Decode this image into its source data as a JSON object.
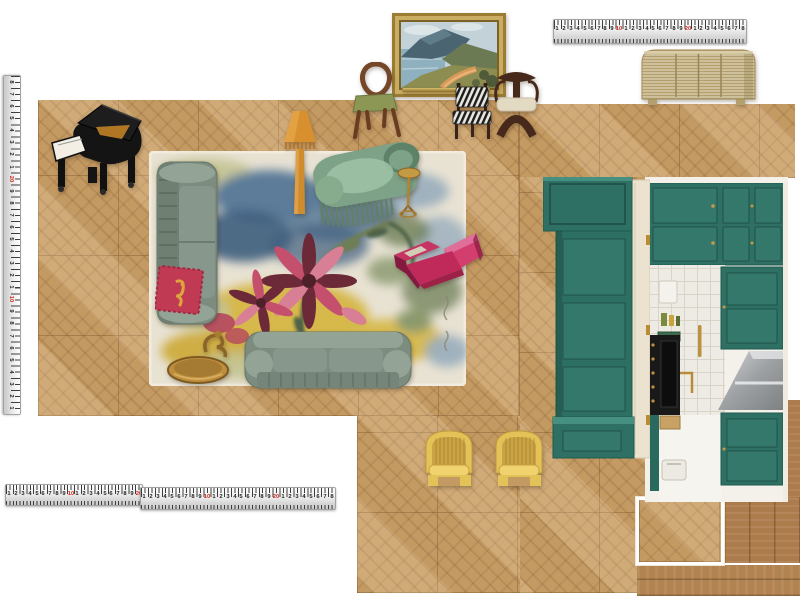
{
  "canvas": {
    "width": 800,
    "height": 600,
    "background": "#ffffff"
  },
  "rulers": {
    "red": [
      "10",
      "20"
    ],
    "top": {
      "numbers": [
        "1",
        "2",
        "3",
        "4",
        "5",
        "6",
        "7",
        "8",
        "9",
        "10",
        "1",
        "2",
        "3",
        "4",
        "5",
        "6",
        "7",
        "8",
        "9",
        "20",
        "1",
        "2",
        "3",
        "4",
        "5",
        "6",
        "7",
        "8"
      ]
    },
    "bottom_a": {
      "numbers": [
        "1",
        "2",
        "3",
        "4",
        "5",
        "6",
        "7",
        "8",
        "9",
        "10",
        "1",
        "2",
        "3",
        "4",
        "5",
        "6",
        "7",
        "8",
        "9",
        "20"
      ]
    },
    "bottom_b": {
      "numbers": [
        "1",
        "2",
        "3",
        "4",
        "5",
        "6",
        "7",
        "8",
        "9",
        "10",
        "1",
        "2",
        "3",
        "4",
        "5",
        "6",
        "7",
        "8",
        "9",
        "20",
        "1",
        "2",
        "3",
        "4",
        "5",
        "6",
        "7",
        "8"
      ]
    },
    "left": {
      "numbers": [
        "8",
        "7",
        "6",
        "5",
        "4",
        "3",
        "2",
        "1",
        "20",
        "9",
        "8",
        "7",
        "6",
        "5",
        "4",
        "3",
        "2",
        "1",
        "10",
        "9",
        "8",
        "7",
        "6",
        "5",
        "4",
        "3",
        "2",
        "1"
      ]
    }
  },
  "palette": {
    "white": "#ffffff",
    "offWhite": "#f4f1ea",
    "tick": "#3c3c3c",
    "redNum": "#cf2a20",
    "floorTan": "#c49a63",
    "teal": "#2e7164",
    "tealDark": "#1f5a4e",
    "tealLight": "#459081",
    "tealPanel": "#33786b",
    "cream": "#ebe3d0",
    "sofa": "#7c8c7f",
    "sofaDark": "#64746a",
    "sofaLight": "#93a396",
    "sofaSeat": "#87978b",
    "chaise": "#7ea287",
    "chaiseDark": "#5d8268",
    "chaiseLight": "#9ec3a6",
    "pink": "#c02a5b",
    "pinkMid": "#d23f6f",
    "pinkLight": "#e06e99",
    "pinkDark": "#851a40",
    "cushRed": "#c13a53",
    "cushGold": "#dfa43c",
    "yellow": "#e5c257",
    "yellowDark": "#c09c3e",
    "yellowLight": "#f0d36f",
    "yellowShadow": "#caa343",
    "gold": "#bf8e3d",
    "goldDark": "#7c5a22",
    "goldLight": "#dcb76a",
    "rattan": "#cec09a",
    "rattanLine": "#a38c58",
    "steel": "#c3c6c8",
    "steelDark": "#85888a",
    "tile": "#edebe3",
    "tileLine": "#d8d4c8",
    "rugCream": "#e8e2d3",
    "rugYellow": "#d6b84c",
    "rugBlue": "#5c7c99",
    "rugBlueDark": "#3e5e7e",
    "rugBlueLight": "#98adbd",
    "rugSage": "#c3c493",
    "rugGreen": "#6e7e55",
    "rugPink": "#d87f96",
    "rugMaroon": "#6c2a38",
    "rugCoral": "#b5475f",
    "piano": "#141414",
    "wood": "#744729",
    "woodDark": "#46291a",
    "paintSky": "#c3d2d8",
    "paintSea": "#8fb0bf",
    "paintMtn": "#4a6472",
    "paintHill": "#6c7a54",
    "paintFg": "#8d8d52",
    "paintPath": "#d99a58",
    "frameGold": "#9c7c33",
    "frameGoldLight": "#c9ad62"
  },
  "items": [
    {
      "id": "floor-parquet",
      "label": "herringbone parquet floor"
    },
    {
      "id": "grand-piano",
      "label": "black grand piano"
    },
    {
      "id": "landscape-painting",
      "label": "framed coastal landscape painting"
    },
    {
      "id": "picture-rail",
      "label": "brass picture rail"
    },
    {
      "id": "bentwood-chair",
      "label": "bentwood dining chair with green seat"
    },
    {
      "id": "zebra-chair",
      "label": "zebra-stripe dining chair"
    },
    {
      "id": "sculptural-chair",
      "label": "dark sculptural dining chair"
    },
    {
      "id": "rattan-sideboard",
      "label": "reeded rattan sideboard"
    },
    {
      "id": "floor-lamp",
      "label": "amber fringe floor lamp"
    },
    {
      "id": "chaise-longue",
      "label": "green velvet fringed chaise longue"
    },
    {
      "id": "martini-table",
      "label": "gold martini side table"
    },
    {
      "id": "sofa-left",
      "label": "green velvet sofa (vertical)"
    },
    {
      "id": "sofa-bottom",
      "label": "green velvet sofa (horizontal)"
    },
    {
      "id": "red-cushion",
      "label": "crimson cushion with gold motif"
    },
    {
      "id": "pink-lounge-chair",
      "label": "magenta velvet lounge chair"
    },
    {
      "id": "gold-side-table",
      "label": "gold sculptural side table"
    },
    {
      "id": "area-rug",
      "label": "abstract floral area rug"
    },
    {
      "id": "green-joinery",
      "label": "teal joinery unit and bench"
    },
    {
      "id": "kitchen",
      "label": "green kitchen with tiled wall"
    },
    {
      "id": "yellow-chair-1",
      "label": "yellow velvet tub chair"
    },
    {
      "id": "yellow-chair-2",
      "label": "yellow velvet tub chair"
    },
    {
      "id": "wood-samples",
      "label": "timber flooring samples"
    },
    {
      "id": "measuring-tapes",
      "label": "measuring tapes"
    }
  ]
}
